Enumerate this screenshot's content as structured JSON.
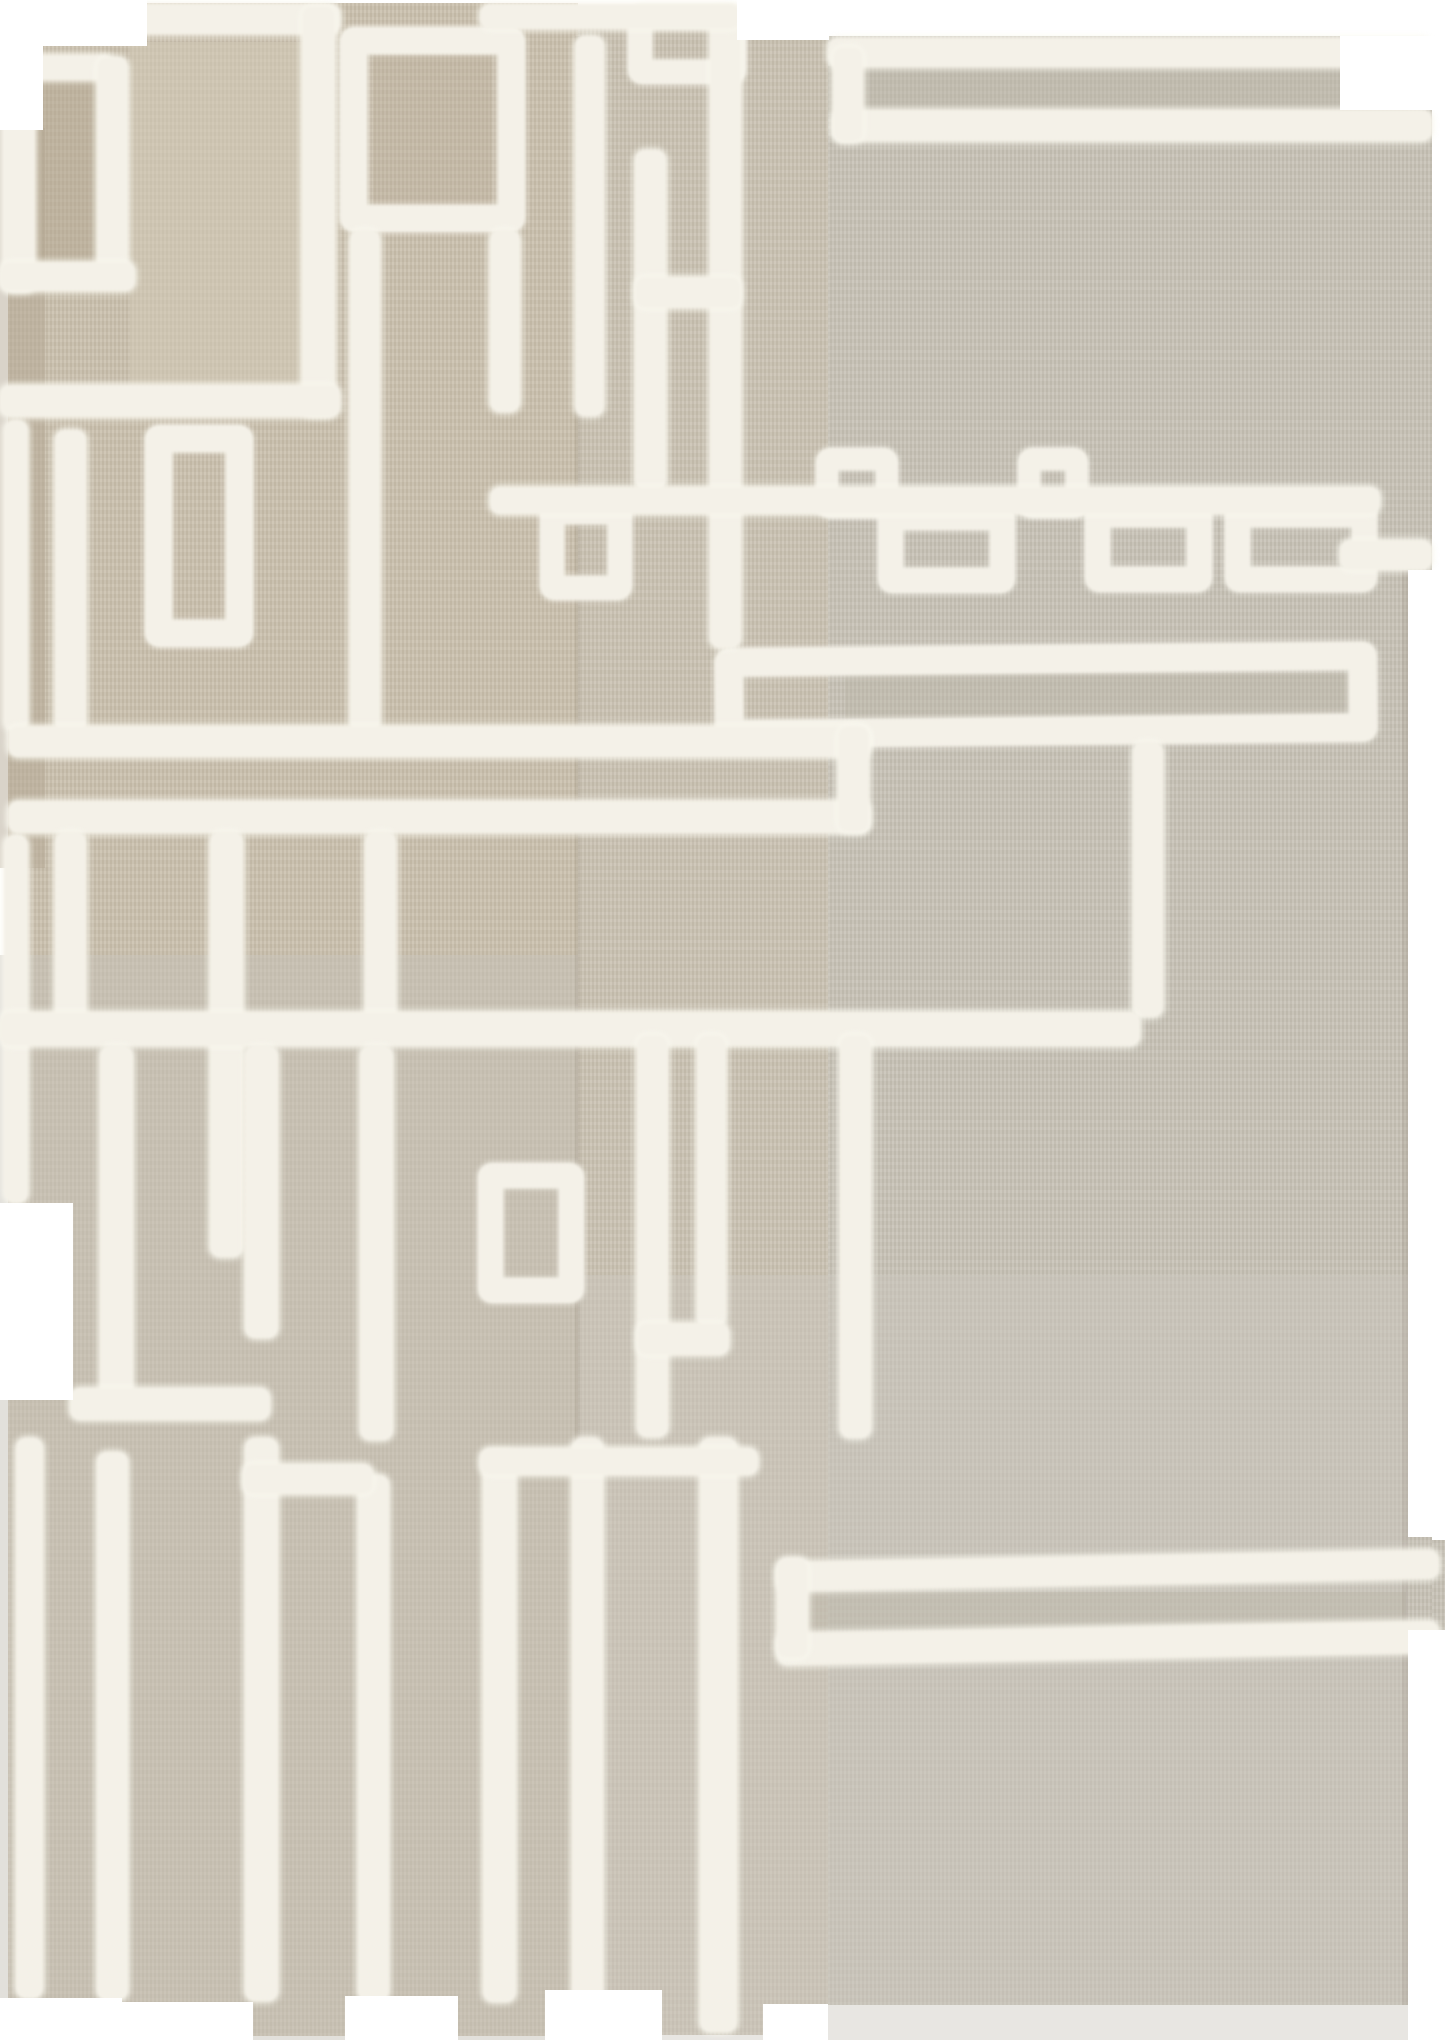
{
  "meta": {
    "description": "Product photograph of a handwoven flat-weave kilim rug in natural beige wool with an abstract geometric maze pattern made of raised white shaggy tufted lines, rectangles and meander chains. The rug has an irregular stepped silhouette with notched edges, photographed on a plain white background.",
    "subject": "beige kilim rug with white tufted geometric pattern",
    "style": "modern abstract / mid-century inspired textile",
    "no_visible_text": true
  },
  "palette": {
    "background": "#ffffff",
    "rug_left_warm_beige": "#c9bfac",
    "rug_center_beige": "#c9c1b1",
    "rug_right_gray_beige": "#c6c1b5",
    "tuft_white": "#f4f1e8",
    "shadow_tan": "#b3a794"
  },
  "canvas": {
    "width": 1445,
    "height": 2040,
    "background": "#ffffff"
  },
  "rug": {
    "pieces": [
      {
        "x": 8,
        "y": 3,
        "w": 570,
        "h": 2033,
        "c": "#c9bfac"
      },
      {
        "x": 578,
        "y": 8,
        "w": 250,
        "h": 2027,
        "c": "#c9c1b1"
      },
      {
        "x": 828,
        "y": 36,
        "w": 604,
        "h": 1969,
        "c": "#c6c1b5"
      },
      {
        "x": 1432,
        "y": 1540,
        "w": 13,
        "h": 90,
        "c": "#c6c1b5"
      }
    ],
    "shade_patches": [
      {
        "x": 0,
        "y": 128,
        "w": 45,
        "h": 740,
        "c": "#b3a794",
        "o": 0.5
      },
      {
        "x": 35,
        "y": 78,
        "w": 68,
        "h": 190,
        "c": "#b1a58f",
        "o": 0.45
      },
      {
        "x": 130,
        "y": 42,
        "w": 175,
        "h": 348,
        "c": "#d3cbb8",
        "o": 0.5
      },
      {
        "x": 373,
        "y": 55,
        "w": 118,
        "h": 178,
        "c": "#b8ad98",
        "o": 0.3
      },
      {
        "x": 0,
        "y": 955,
        "w": 578,
        "h": 1085,
        "c": "#c5c1b8",
        "o": 0.5
      },
      {
        "x": 828,
        "y": 66,
        "w": 580,
        "h": 48,
        "c": "#bab4a6",
        "o": 0.4
      },
      {
        "x": 578,
        "y": 1275,
        "w": 830,
        "h": 765,
        "c": "#ccc8be",
        "o": 0.45
      },
      {
        "x": 806,
        "y": 1592,
        "w": 600,
        "h": 38,
        "c": "#bcb6a8",
        "o": 0.4
      },
      {
        "x": 845,
        "y": 673,
        "w": 505,
        "h": 46,
        "c": "#bab4a6",
        "o": 0.35
      },
      {
        "x": 575,
        "y": 36,
        "w": 5,
        "h": 1990,
        "c": "#8a8070",
        "o": 0.18
      },
      {
        "x": 1402,
        "y": 570,
        "w": 6,
        "h": 1435,
        "c": "#8a8070",
        "o": 0.15
      }
    ],
    "tuft_lines": [
      {
        "x": 45,
        "y": 4,
        "w": 295,
        "h": 30
      },
      {
        "x": 302,
        "y": 6,
        "w": 33,
        "h": 410
      },
      {
        "x": 0,
        "y": 385,
        "w": 340,
        "h": 32
      },
      {
        "x": 3,
        "y": 50,
        "w": 32,
        "h": 242
      },
      {
        "x": 3,
        "y": 55,
        "w": 110,
        "h": 25
      },
      {
        "x": 97,
        "y": 57,
        "w": 31,
        "h": 222
      },
      {
        "x": 0,
        "y": 262,
        "w": 135,
        "h": 29
      },
      {
        "x": 350,
        "y": 230,
        "w": 30,
        "h": 502
      },
      {
        "x": 490,
        "y": 230,
        "w": 30,
        "h": 182
      },
      {
        "x": 575,
        "y": 36,
        "w": 29,
        "h": 380
      },
      {
        "x": 635,
        "y": 150,
        "w": 31,
        "h": 340
      },
      {
        "x": 710,
        "y": 8,
        "w": 31,
        "h": 640
      },
      {
        "x": 635,
        "y": 277,
        "w": 106,
        "h": 31
      },
      {
        "x": 480,
        "y": 4,
        "w": 260,
        "h": 25
      },
      {
        "x": 828,
        "y": 38,
        "w": 604,
        "h": 29
      },
      {
        "x": 833,
        "y": 110,
        "w": 599,
        "h": 31
      },
      {
        "x": 833,
        "y": 47,
        "w": 30,
        "h": 95
      },
      {
        "x": 1340,
        "y": 540,
        "w": 92,
        "h": 30
      },
      {
        "x": 55,
        "y": 430,
        "w": 31,
        "h": 302
      },
      {
        "x": 4,
        "y": 420,
        "w": 24,
        "h": 312
      },
      {
        "x": 4,
        "y": 835,
        "w": 24,
        "h": 368
      },
      {
        "x": 490,
        "y": 487,
        "w": 890,
        "h": 27
      },
      {
        "x": 1133,
        "y": 742,
        "w": 30,
        "h": 275
      },
      {
        "x": 8,
        "y": 726,
        "w": 862,
        "h": 31
      },
      {
        "x": 8,
        "y": 801,
        "w": 862,
        "h": 32
      },
      {
        "x": 838,
        "y": 726,
        "w": 31,
        "h": 106
      },
      {
        "x": 55,
        "y": 832,
        "w": 31,
        "h": 198
      },
      {
        "x": 210,
        "y": 832,
        "w": 33,
        "h": 425
      },
      {
        "x": 365,
        "y": 832,
        "w": 31,
        "h": 198
      },
      {
        "x": 0,
        "y": 1012,
        "w": 1140,
        "h": 34
      },
      {
        "x": 100,
        "y": 1046,
        "w": 33,
        "h": 354
      },
      {
        "x": 245,
        "y": 1046,
        "w": 33,
        "h": 292
      },
      {
        "x": 360,
        "y": 1046,
        "w": 33,
        "h": 394
      },
      {
        "x": 70,
        "y": 1388,
        "w": 200,
        "h": 32
      },
      {
        "x": 637,
        "y": 1035,
        "w": 31,
        "h": 402
      },
      {
        "x": 697,
        "y": 1035,
        "w": 29,
        "h": 292
      },
      {
        "x": 637,
        "y": 1323,
        "w": 92,
        "h": 32
      },
      {
        "x": 840,
        "y": 1035,
        "w": 31,
        "h": 403
      },
      {
        "x": 16,
        "y": 1438,
        "w": 27,
        "h": 560
      },
      {
        "x": 97,
        "y": 1452,
        "w": 31,
        "h": 548
      },
      {
        "x": 245,
        "y": 1438,
        "w": 33,
        "h": 563
      },
      {
        "x": 358,
        "y": 1475,
        "w": 31,
        "h": 526
      },
      {
        "x": 483,
        "y": 1452,
        "w": 33,
        "h": 550
      },
      {
        "x": 572,
        "y": 1438,
        "w": 31,
        "h": 563
      },
      {
        "x": 700,
        "y": 1438,
        "w": 37,
        "h": 594
      },
      {
        "x": 243,
        "y": 1464,
        "w": 130,
        "h": 30
      },
      {
        "x": 480,
        "y": 1448,
        "w": 278,
        "h": 27
      },
      {
        "x": 777,
        "y": 1556,
        "w": 662,
        "h": 29,
        "r": -1.1
      },
      {
        "x": 777,
        "y": 1627,
        "w": 662,
        "h": 32,
        "r": -1.1
      },
      {
        "x": 777,
        "y": 1558,
        "w": 31,
        "h": 100
      }
    ],
    "tuft_boxes": [
      {
        "x": 340,
        "y": 27,
        "w": 185,
        "h": 205
      },
      {
        "x": 628,
        "y": 4,
        "w": 118,
        "h": 80,
        "b": 24
      },
      {
        "x": 145,
        "y": 425,
        "w": 108,
        "h": 222
      },
      {
        "x": 540,
        "y": 500,
        "w": 92,
        "h": 100,
        "b": 24
      },
      {
        "x": 816,
        "y": 448,
        "w": 82,
        "h": 70,
        "b": 22
      },
      {
        "x": 1018,
        "y": 448,
        "w": 70,
        "h": 70,
        "b": 22
      },
      {
        "x": 878,
        "y": 505,
        "w": 137,
        "h": 88,
        "b": 25
      },
      {
        "x": 1085,
        "y": 502,
        "w": 127,
        "h": 90,
        "b": 25
      },
      {
        "x": 1225,
        "y": 502,
        "w": 152,
        "h": 90,
        "b": 25
      },
      {
        "x": 715,
        "y": 645,
        "w": 662,
        "h": 100,
        "b": 28,
        "r": -0.6
      },
      {
        "x": 478,
        "y": 1163,
        "w": 106,
        "h": 140,
        "b": 25
      }
    ],
    "cutouts": [
      {
        "x": 0,
        "y": 0,
        "w": 147,
        "h": 46
      },
      {
        "x": 0,
        "y": 46,
        "w": 43,
        "h": 84
      },
      {
        "x": 737,
        "y": 0,
        "w": 92,
        "h": 40
      },
      {
        "x": 1340,
        "y": 36,
        "w": 105,
        "h": 74
      },
      {
        "x": 1408,
        "y": 570,
        "w": 37,
        "h": 967
      },
      {
        "x": 1408,
        "y": 1630,
        "w": 37,
        "h": 378
      },
      {
        "x": 0,
        "y": 1203,
        "w": 73,
        "h": 197
      },
      {
        "x": 122,
        "y": 2002,
        "w": 131,
        "h": 38
      },
      {
        "x": 345,
        "y": 1996,
        "w": 113,
        "h": 44
      },
      {
        "x": 545,
        "y": 1990,
        "w": 117,
        "h": 50
      },
      {
        "x": 0,
        "y": 1998,
        "w": 122,
        "h": 42
      },
      {
        "x": 763,
        "y": 2004,
        "w": 65,
        "h": 36
      }
    ]
  }
}
